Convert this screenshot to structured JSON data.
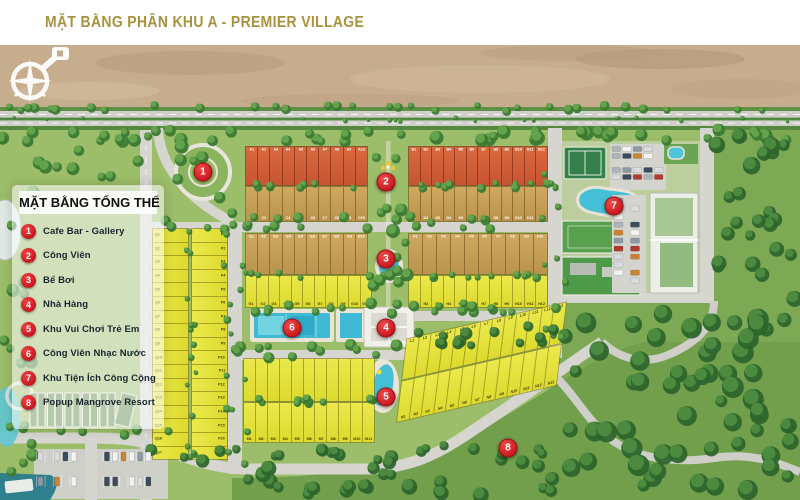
{
  "title": "MẶT BẰNG PHÂN KHU A - PREMIER VILLAGE",
  "legend": {
    "title": "MẶT BẰNG TỔNG THỂ",
    "items": [
      {
        "num": "1",
        "label": "Cafe Bar - Gallery"
      },
      {
        "num": "2",
        "label": "Công Viên"
      },
      {
        "num": "3",
        "label": "Bể Bơi"
      },
      {
        "num": "4",
        "label": "Nhà Hàng"
      },
      {
        "num": "5",
        "label": "Khu Vui Chơi Trẻ Em"
      },
      {
        "num": "6",
        "label": "Công Viên Nhạc Nước"
      },
      {
        "num": "7",
        "label": "Khu Tiện Ích Công Cộng"
      },
      {
        "num": "8",
        "label": "Popup Mangrove Resort"
      }
    ]
  },
  "colors": {
    "title_gold": "#a8923d",
    "marker_red": "#c8191f",
    "plot_orange": "#d2613a",
    "plot_tan": "#c6a259",
    "plot_yellow": "#e7e63e",
    "water": "#45c0d6",
    "sand": "#c6ad8e",
    "greenery": "#7da954"
  },
  "blocks": {
    "A": [
      "A1",
      "A2",
      "A3",
      "A4",
      "A5",
      "A6",
      "A7",
      "A8",
      "A9",
      "A10"
    ],
    "B": [
      "B1",
      "B2",
      "B3",
      "B4",
      "B5",
      "B6",
      "B7",
      "B8",
      "B9",
      "B10",
      "B11",
      "B12"
    ],
    "C": [
      "C1",
      "C2",
      "C3",
      "C4",
      "C5",
      "C6",
      "C7",
      "C8",
      "C9",
      "C10"
    ],
    "D": [
      "D1",
      "D2",
      "D3",
      "D4",
      "D5",
      "D6",
      "D7",
      "D8",
      "D9",
      "D10",
      "D11",
      "D12"
    ],
    "E": [
      "E1",
      "E2",
      "E3",
      "E4",
      "E5",
      "E6",
      "E7",
      "E8",
      "E9",
      "E10"
    ],
    "F": [
      "F1",
      "F2",
      "F3",
      "F4",
      "F5",
      "F6",
      "F7",
      "F8",
      "F9",
      "F10"
    ],
    "G": [
      "G1",
      "G2",
      "G3",
      "G4",
      "G5",
      "G6",
      "G7",
      "G8",
      "G9",
      "G10",
      "G11"
    ],
    "H": [
      "H1",
      "H2",
      "H3",
      "H4",
      "H5",
      "H6",
      "H7",
      "H8",
      "H9",
      "H10",
      "H11",
      "H12"
    ],
    "Q": [
      "Q1",
      "Q2",
      "Q3",
      "Q4",
      "Q5",
      "Q6",
      "Q7",
      "Q8",
      "Q9",
      "Q10",
      "Q11",
      "Q12",
      "Q13",
      "Q14",
      "Q15",
      "Q16",
      "Q17"
    ],
    "P": [
      "P1",
      "P2",
      "P3",
      "P4",
      "P5",
      "P6",
      "P7",
      "P8",
      "P9",
      "P10",
      "P11",
      "P12",
      "P13",
      "P14",
      "P15",
      "P16",
      "P17"
    ],
    "K": [
      "",
      "",
      "",
      "",
      "",
      "",
      "",
      "",
      "",
      "",
      ""
    ],
    "M": [
      "M1",
      "M2",
      "M3",
      "M4",
      "M5",
      "M6",
      "M7",
      "M8",
      "M9",
      "M10",
      "M11"
    ],
    "L": [
      "L1",
      "L2",
      "L3",
      "L4",
      "L5",
      "L6",
      "L7",
      "L8",
      "L9",
      "L10",
      "L11",
      "L12",
      "L13"
    ],
    "N": [
      "N1",
      "N2",
      "N3",
      "N4",
      "N5",
      "N6",
      "N7",
      "N8",
      "N9",
      "N10",
      "N11",
      "N12",
      "N13"
    ]
  }
}
